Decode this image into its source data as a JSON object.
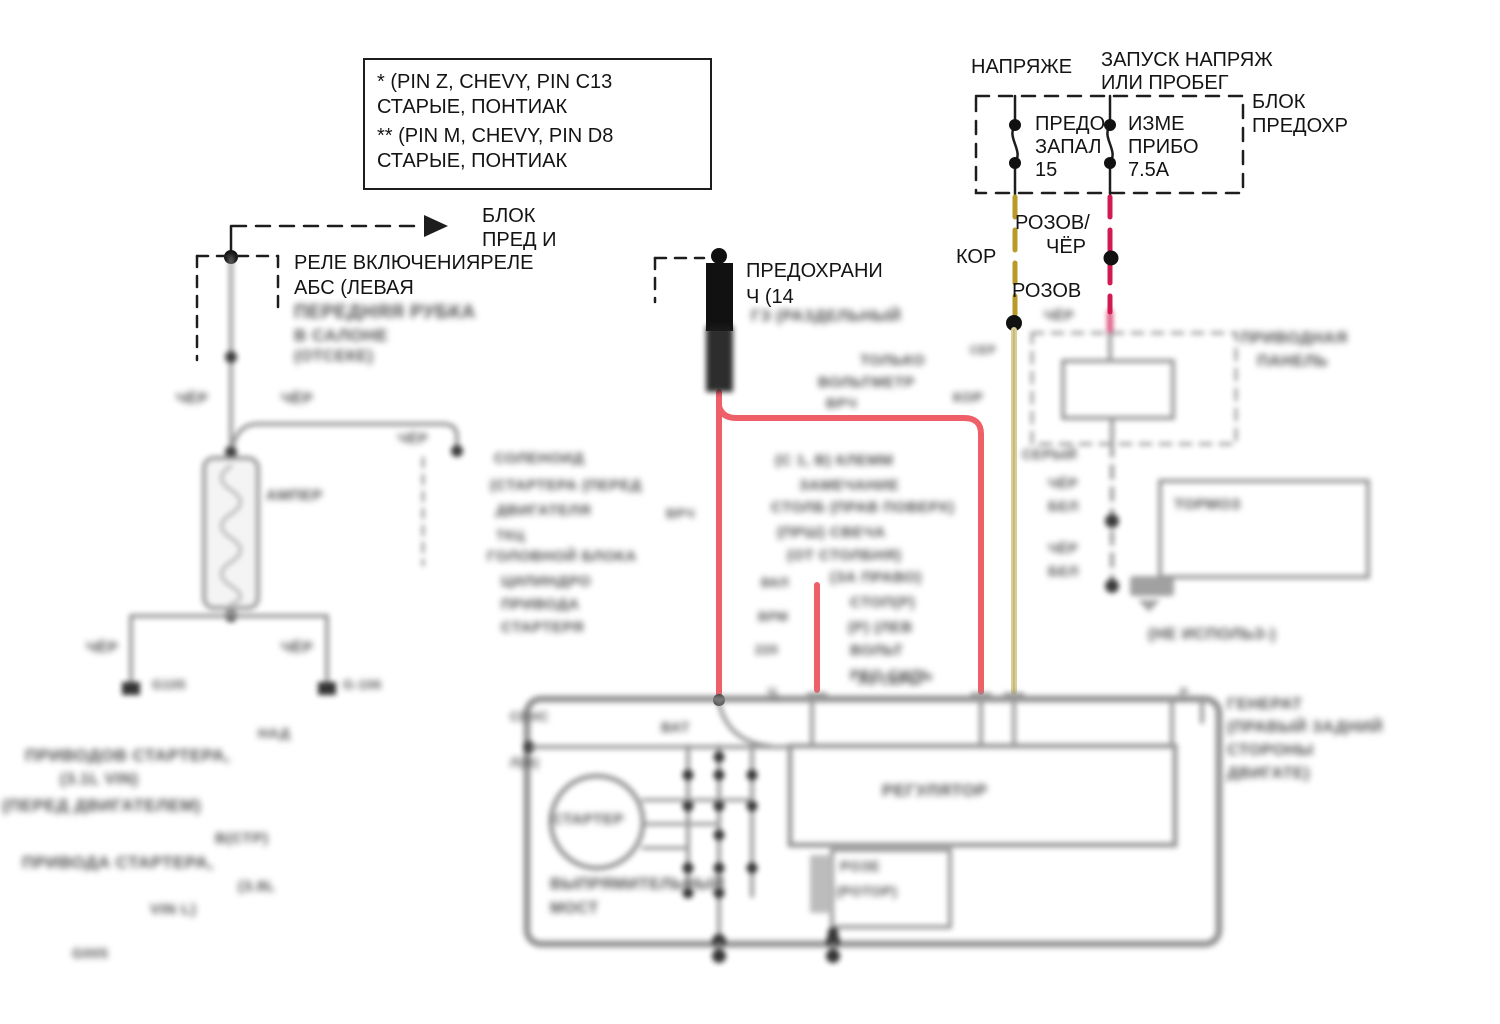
{
  "colors": {
    "red_wire": "#ef5f68",
    "olive_wire": "#b99a28",
    "khaki_wire": "#d8cf9c",
    "crimson_wire": "#d11a52",
    "grey_wire": "#8f8f8f",
    "ink": "#141414"
  },
  "note_box": {
    "line1": "* (PIN Z, CHEVY, PIN C13",
    "line2": "СТАРЫЕ, ПОНТИАК",
    "line3": "** (PIN M, CHEVY, PIN D8",
    "line4": "СТАРЫЕ, ПОНТИАК"
  },
  "labels": [
    {
      "name": "note-line-1",
      "text": "* (PIN Z, CHEVY, PIN C13",
      "x": 377,
      "y": 72,
      "fs": 20,
      "blur": false
    },
    {
      "name": "note-line-2",
      "text": "СТАРЫЕ, ПОНТИАК",
      "x": 377,
      "y": 97,
      "fs": 20,
      "blur": false
    },
    {
      "name": "note-line-3",
      "text": "** (PIN M, CHEVY, PIN D8",
      "x": 377,
      "y": 126,
      "fs": 20,
      "blur": false
    },
    {
      "name": "note-line-4",
      "text": "СТАРЫЕ, ПОНТИАК",
      "x": 377,
      "y": 151,
      "fs": 20,
      "blur": false
    },
    {
      "name": "voltage-title",
      "text": "НАПРЯЖЕ",
      "x": 971,
      "y": 57,
      "fs": 20,
      "blur": false
    },
    {
      "name": "run-title-line-1",
      "text": "ЗАПУСК НАПРЯЖ",
      "x": 1101,
      "y": 50,
      "fs": 20,
      "blur": false
    },
    {
      "name": "run-title-line-2",
      "text": "ИЛИ ПРОБЕГ",
      "x": 1101,
      "y": 73,
      "fs": 20,
      "blur": false
    },
    {
      "name": "fuse-block-label-1",
      "text": "БЛОК",
      "x": 1252,
      "y": 92,
      "fs": 20,
      "blur": false
    },
    {
      "name": "fuse-block-label-2",
      "text": "ПРЕДОХР",
      "x": 1252,
      "y": 116,
      "fs": 20,
      "blur": false
    },
    {
      "name": "fuse1-label-1",
      "text": "ПРЕДО",
      "x": 1035,
      "y": 114,
      "fs": 20,
      "blur": false
    },
    {
      "name": "fuse1-label-2",
      "text": "ЗАПАЛ",
      "x": 1035,
      "y": 137,
      "fs": 20,
      "blur": false
    },
    {
      "name": "fuse1-rating",
      "text": "15",
      "x": 1035,
      "y": 160,
      "fs": 20,
      "blur": false
    },
    {
      "name": "fuse2-label-1",
      "text": "ИЗМЕ",
      "x": 1128,
      "y": 114,
      "fs": 20,
      "blur": false
    },
    {
      "name": "fuse2-label-2",
      "text": "ПРИБО",
      "x": 1128,
      "y": 137,
      "fs": 20,
      "blur": false
    },
    {
      "name": "fuse2-rating",
      "text": "7.5А",
      "x": 1128,
      "y": 160,
      "fs": 20,
      "blur": false
    },
    {
      "name": "wire-color-pink-blk-1",
      "text": "РОЗОВ/",
      "x": 1015,
      "y": 213,
      "fs": 20,
      "blur": false
    },
    {
      "name": "wire-color-pink-blk-2",
      "text": "ЧЁР",
      "x": 1046,
      "y": 237,
      "fs": 20,
      "blur": false
    },
    {
      "name": "wire-color-brown",
      "text": "КОР",
      "x": 956,
      "y": 247,
      "fs": 20,
      "blur": false
    },
    {
      "name": "wire-color-pink",
      "text": "РОЗОВ",
      "x": 1012,
      "y": 281,
      "fs": 20,
      "blur": false
    },
    {
      "name": "fuse-block-ref-1",
      "text": "БЛОК",
      "x": 482,
      "y": 206,
      "fs": 20,
      "blur": false
    },
    {
      "name": "fuse-block-ref-2",
      "text": "ПРЕД И",
      "x": 482,
      "y": 230,
      "fs": 20,
      "blur": false
    },
    {
      "name": "relay-label-1",
      "text": "РЕЛЕ ВКЛЮЧЕНИЯРЕЛЕ",
      "x": 294,
      "y": 253,
      "fs": 20,
      "blur": false
    },
    {
      "name": "relay-label-2",
      "text": "АБС (ЛЕВАЯ",
      "x": 294,
      "y": 278,
      "fs": 20,
      "blur": false
    },
    {
      "name": "fusible-link-label-1",
      "text": "ПРЕДОХРАНИ",
      "x": 746,
      "y": 261,
      "fs": 20,
      "blur": false
    },
    {
      "name": "fusible-link-label-2",
      "text": "Ч (14",
      "x": 746,
      "y": 287,
      "fs": 20,
      "blur": false
    },
    {
      "name": "blurred-label",
      "text": "ПЕРЕДНЯЯ РУБКА",
      "x": 294,
      "y": 303,
      "fs": 19,
      "blur": true
    },
    {
      "name": "blurred-label",
      "text": "В САЛОНЕ",
      "x": 294,
      "y": 327,
      "fs": 17,
      "blur": true
    },
    {
      "name": "blurred-label",
      "text": "(ОТСЕКЕ)",
      "x": 294,
      "y": 349,
      "fs": 16,
      "blur": true
    },
    {
      "name": "blurred-label",
      "text": "ЧЁР",
      "x": 176,
      "y": 391,
      "fs": 15,
      "blur": true
    },
    {
      "name": "blurred-label",
      "text": "ЧЁР",
      "x": 281,
      "y": 391,
      "fs": 15,
      "blur": true
    },
    {
      "name": "blurred-label",
      "text": "ЧЁР",
      "x": 398,
      "y": 431,
      "fs": 14,
      "blur": true
    },
    {
      "name": "blurred-label",
      "text": "АМПЕР",
      "x": 266,
      "y": 488,
      "fs": 15,
      "blur": true
    },
    {
      "name": "blurred-label",
      "text": "ЧЁР",
      "x": 86,
      "y": 640,
      "fs": 15,
      "blur": true
    },
    {
      "name": "blurred-label",
      "text": "ЧЁР",
      "x": 281,
      "y": 640,
      "fs": 15,
      "blur": true
    },
    {
      "name": "blurred-label",
      "text": "G105",
      "x": 152,
      "y": 678,
      "fs": 13,
      "blur": true
    },
    {
      "name": "blurred-label",
      "text": "G-106",
      "x": 343,
      "y": 678,
      "fs": 13,
      "blur": true
    },
    {
      "name": "blurred-label",
      "text": "НАД",
      "x": 258,
      "y": 726,
      "fs": 14,
      "blur": true
    },
    {
      "name": "blurred-label",
      "text": "ПРИВОДОВ СТАРТЕРА,",
      "x": 25,
      "y": 747,
      "fs": 17,
      "blur": true
    },
    {
      "name": "blurred-label",
      "text": "(3.1L VIN)",
      "x": 60,
      "y": 772,
      "fs": 16,
      "blur": true
    },
    {
      "name": "blurred-label",
      "text": "(ПЕРЕД ДВИГАТЕЛЕМ)",
      "x": 2,
      "y": 797,
      "fs": 17,
      "blur": true
    },
    {
      "name": "blurred-label",
      "text": "В(СТР)",
      "x": 215,
      "y": 831,
      "fs": 15,
      "blur": true
    },
    {
      "name": "blurred-label",
      "text": "ПРИВОДА СТАРТЕРА,",
      "x": 22,
      "y": 854,
      "fs": 17,
      "blur": true
    },
    {
      "name": "blurred-label",
      "text": "(3.8L",
      "x": 238,
      "y": 879,
      "fs": 15,
      "blur": true
    },
    {
      "name": "blurred-label",
      "text": "VIN L)",
      "x": 150,
      "y": 902,
      "fs": 15,
      "blur": true
    },
    {
      "name": "blurred-label",
      "text": "G005",
      "x": 72,
      "y": 946,
      "fs": 14,
      "blur": true
    },
    {
      "name": "blurred-label",
      "text": "СОЛЕНОИД",
      "x": 494,
      "y": 451,
      "fs": 15,
      "blur": true
    },
    {
      "name": "blurred-label",
      "text": "(СТАРТЕРА (ПЕРЕД",
      "x": 490,
      "y": 478,
      "fs": 15,
      "blur": true
    },
    {
      "name": "blurred-label",
      "text": "ДВИГАТЕЛЯ",
      "x": 496,
      "y": 503,
      "fs": 15,
      "blur": true
    },
    {
      "name": "blurred-label",
      "text": "ВРЧ",
      "x": 666,
      "y": 507,
      "fs": 13,
      "blur": true
    },
    {
      "name": "blurred-label",
      "text": "ТКЦ",
      "x": 496,
      "y": 528,
      "fs": 14,
      "blur": true
    },
    {
      "name": "blurred-label",
      "text": "ГОЛОВНОЙ БЛОКА",
      "x": 487,
      "y": 549,
      "fs": 15,
      "blur": true
    },
    {
      "name": "blurred-label",
      "text": "ЦИЛИНДРО",
      "x": 501,
      "y": 574,
      "fs": 15,
      "blur": true
    },
    {
      "name": "blurred-label",
      "text": "ПРИВОДА",
      "x": 501,
      "y": 597,
      "fs": 15,
      "blur": true
    },
    {
      "name": "blurred-label",
      "text": "СТАРТЕРЯ",
      "x": 501,
      "y": 620,
      "fs": 15,
      "blur": true
    },
    {
      "name": "blurred-label",
      "text": "ГЗ (РАЗДЕЛЬНЫЙ",
      "x": 751,
      "y": 309,
      "fs": 16,
      "blur": true
    },
    {
      "name": "blurred-label",
      "text": "ТОЛЬКО",
      "x": 860,
      "y": 353,
      "fs": 15,
      "blur": true
    },
    {
      "name": "blurred-label",
      "text": "ВОЛЬТМЕТР",
      "x": 818,
      "y": 375,
      "fs": 15,
      "blur": true
    },
    {
      "name": "blurred-label",
      "text": "ВРЧ",
      "x": 826,
      "y": 396,
      "fs": 14,
      "blur": true
    },
    {
      "name": "blurred-label",
      "text": "КОР",
      "x": 953,
      "y": 390,
      "fs": 14,
      "blur": true
    },
    {
      "name": "blurred-label",
      "text": "СЕР",
      "x": 970,
      "y": 344,
      "fs": 12,
      "blur": true
    },
    {
      "name": "blurred-label",
      "text": "(С 1, В) КЛЕММ",
      "x": 775,
      "y": 453,
      "fs": 15,
      "blur": true
    },
    {
      "name": "blurred-label",
      "text": "ЗАМЕЧАНИЕ",
      "x": 799,
      "y": 478,
      "fs": 15,
      "blur": true
    },
    {
      "name": "blurred-label",
      "text": "СТОЛБ (ПРАВ ПОВЕРХ)",
      "x": 771,
      "y": 500,
      "fs": 15,
      "blur": true
    },
    {
      "name": "blurred-label",
      "text": "(ПРШ) СВЕЧА",
      "x": 777,
      "y": 525,
      "fs": 15,
      "blur": true
    },
    {
      "name": "blurred-label",
      "text": "(ОТ СТОЛБНЯ)",
      "x": 787,
      "y": 548,
      "fs": 15,
      "blur": true
    },
    {
      "name": "blurred-label",
      "text": "(ЗА ПРАВО)",
      "x": 830,
      "y": 570,
      "fs": 15,
      "blur": true
    },
    {
      "name": "blurred-label",
      "text": "ВКЛ",
      "x": 761,
      "y": 576,
      "fs": 13,
      "blur": true
    },
    {
      "name": "blurred-label",
      "text": "СТОП(Р)",
      "x": 850,
      "y": 595,
      "fs": 15,
      "blur": true
    },
    {
      "name": "blurred-label",
      "text": "ВРМ",
      "x": 758,
      "y": 610,
      "fs": 13,
      "blur": true
    },
    {
      "name": "blurred-label",
      "text": "(Р) (ЛЕВ",
      "x": 848,
      "y": 620,
      "fs": 15,
      "blur": true
    },
    {
      "name": "blurred-label",
      "text": "220",
      "x": 755,
      "y": 643,
      "fs": 13,
      "blur": true
    },
    {
      "name": "blurred-label",
      "text": "ВОЛЬТ",
      "x": 850,
      "y": 643,
      "fs": 15,
      "blur": true
    },
    {
      "name": "blurred-label",
      "text": "РЕО СИЛЬ",
      "x": 850,
      "y": 668,
      "fs": 15,
      "blur": true
    },
    {
      "name": "blurred-label",
      "text": "Ц",
      "x": 768,
      "y": 686,
      "fs": 12,
      "blur": true
    },
    {
      "name": "blurred-label",
      "text": "ЧЁР",
      "x": 1044,
      "y": 308,
      "fs": 14,
      "blur": true
    },
    {
      "name": "blurred-label",
      "text": "ПРИВОДНАЯ",
      "x": 1240,
      "y": 331,
      "fs": 16,
      "blur": true
    },
    {
      "name": "blurred-label",
      "text": "ПАНЕЛЬ",
      "x": 1257,
      "y": 354,
      "fs": 16,
      "blur": true
    },
    {
      "name": "blurred-label",
      "text": "СЕРЫЙ",
      "x": 1022,
      "y": 447,
      "fs": 14,
      "blur": true
    },
    {
      "name": "blurred-label",
      "text": "ЧЁР",
      "x": 1048,
      "y": 476,
      "fs": 14,
      "blur": true
    },
    {
      "name": "blurred-label",
      "text": "БЕЛ",
      "x": 1048,
      "y": 499,
      "fs": 14,
      "blur": true
    },
    {
      "name": "blurred-label",
      "text": "ЧЁР",
      "x": 1048,
      "y": 541,
      "fs": 14,
      "blur": true
    },
    {
      "name": "blurred-label",
      "text": "БЕЛ",
      "x": 1048,
      "y": 564,
      "fs": 14,
      "blur": true
    },
    {
      "name": "blurred-label",
      "text": "ТОРМОЗ",
      "x": 1174,
      "y": 497,
      "fs": 15,
      "blur": true
    },
    {
      "name": "blurred-label",
      "text": "(НЕ ИСПОЛЬЗ-)",
      "x": 1148,
      "y": 627,
      "fs": 16,
      "blur": true
    },
    {
      "name": "blurred-label",
      "text": "СЕНС",
      "x": 510,
      "y": 710,
      "fs": 13,
      "blur": true
    },
    {
      "name": "blurred-label",
      "text": "Л(В)",
      "x": 510,
      "y": 756,
      "fs": 13,
      "blur": true
    },
    {
      "name": "blurred-label",
      "text": "ВАТ",
      "x": 661,
      "y": 720,
      "fs": 14,
      "blur": true
    },
    {
      "name": "blurred-label",
      "text": "ЛЗ СЕРЫ",
      "x": 858,
      "y": 674,
      "fs": 13,
      "blur": true
    },
    {
      "name": "blurred-label",
      "text": "Р",
      "x": 1180,
      "y": 687,
      "fs": 12,
      "blur": true
    },
    {
      "name": "blurred-label",
      "text": "СТАРТЕР",
      "x": 552,
      "y": 812,
      "fs": 15,
      "blur": true
    },
    {
      "name": "blurred-label",
      "text": "РЕГУЛЯТОР",
      "x": 882,
      "y": 782,
      "fs": 17,
      "blur": true
    },
    {
      "name": "blurred-label",
      "text": "РОЗЕ",
      "x": 840,
      "y": 859,
      "fs": 14,
      "blur": true
    },
    {
      "name": "blurred-label",
      "text": "(РОТОР)",
      "x": 836,
      "y": 884,
      "fs": 14,
      "blur": true
    },
    {
      "name": "blurred-label",
      "text": "ВЫПРЯМИТЕЛЬНЫЙ",
      "x": 550,
      "y": 877,
      "fs": 16,
      "blur": true
    },
    {
      "name": "blurred-label",
      "text": "МОСТ",
      "x": 550,
      "y": 901,
      "fs": 16,
      "blur": true
    },
    {
      "name": "blurred-label",
      "text": "ГЕНЕРАТ",
      "x": 1227,
      "y": 697,
      "fs": 16,
      "blur": true
    },
    {
      "name": "blurred-label",
      "text": "(ПРАВЫЙ ЗАДНИЙ",
      "x": 1227,
      "y": 720,
      "fs": 16,
      "blur": true
    },
    {
      "name": "blurred-label",
      "text": "СТОРОНЫ",
      "x": 1227,
      "y": 743,
      "fs": 16,
      "blur": true
    },
    {
      "name": "blurred-label",
      "text": "ДВИГАТЕ)",
      "x": 1227,
      "y": 766,
      "fs": 16,
      "blur": true
    }
  ]
}
